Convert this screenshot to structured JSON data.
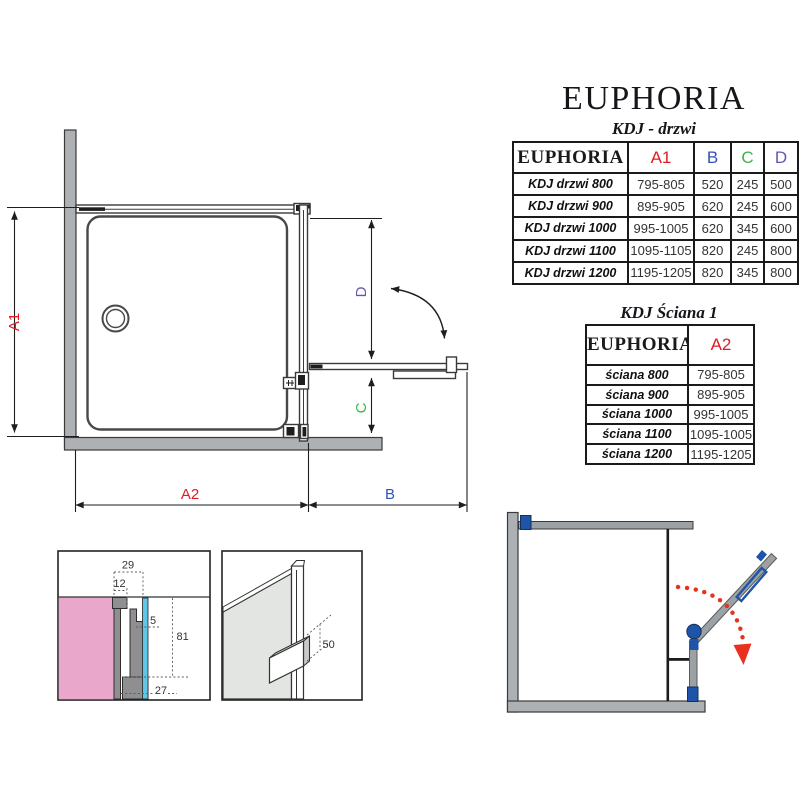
{
  "header": {
    "brand": "EUPHORIA",
    "series": "KDJ - drzwi"
  },
  "door_table": {
    "product_header": "EUPHORIA",
    "columns": {
      "a1": "A1",
      "b": "B",
      "c": "C",
      "d": "D"
    },
    "rows": [
      {
        "label": "KDJ drzwi 800",
        "a1": "795-805",
        "b": "520",
        "c": "245",
        "d": "500"
      },
      {
        "label": "KDJ drzwi 900",
        "a1": "895-905",
        "b": "620",
        "c": "245",
        "d": "600"
      },
      {
        "label": "KDJ drzwi 1000",
        "a1": "995-1005",
        "b": "620",
        "c": "345",
        "d": "600"
      },
      {
        "label": "KDJ drzwi 1100",
        "a1": "1095-1105",
        "b": "820",
        "c": "245",
        "d": "800"
      },
      {
        "label": "KDJ drzwi 1200",
        "a1": "1195-1205",
        "b": "820",
        "c": "345",
        "d": "800"
      }
    ]
  },
  "wall_table": {
    "title": "KDJ Ściana 1",
    "product_header": "EUPHORIA",
    "column": "A2",
    "rows": [
      {
        "label": "ściana 800",
        "a2": "795-805"
      },
      {
        "label": "ściana 900",
        "a2": "895-905"
      },
      {
        "label": "ściana 1000",
        "a2": "995-1005"
      },
      {
        "label": "ściana 1100",
        "a2": "1095-1005"
      },
      {
        "label": "ściana 1200",
        "a2": "1195-1205"
      }
    ]
  },
  "plan": {
    "dim_a1": "A1",
    "dim_a2": "A2",
    "dim_b": "B",
    "dim_c": "C",
    "dim_d": "D"
  },
  "detail_profile": {
    "dim_29": "29",
    "dim_12": "12",
    "dim_5": "5",
    "dim_81": "81",
    "dim_27": "27"
  },
  "detail_handle": {
    "dim_50": "50"
  },
  "colors": {
    "dim_a_red": "#e01b24",
    "dim_b_blue": "#3152bc",
    "dim_c_green": "#3cb54a",
    "dim_d_purple": "#6655b4",
    "wall_gray": "#adb1b4",
    "hardware_blue": "#1f55a8",
    "swing_arrow_red": "#e8311f",
    "wall_section_pink": "#e9a7cc",
    "glass_cyan": "#5ec7e8"
  }
}
